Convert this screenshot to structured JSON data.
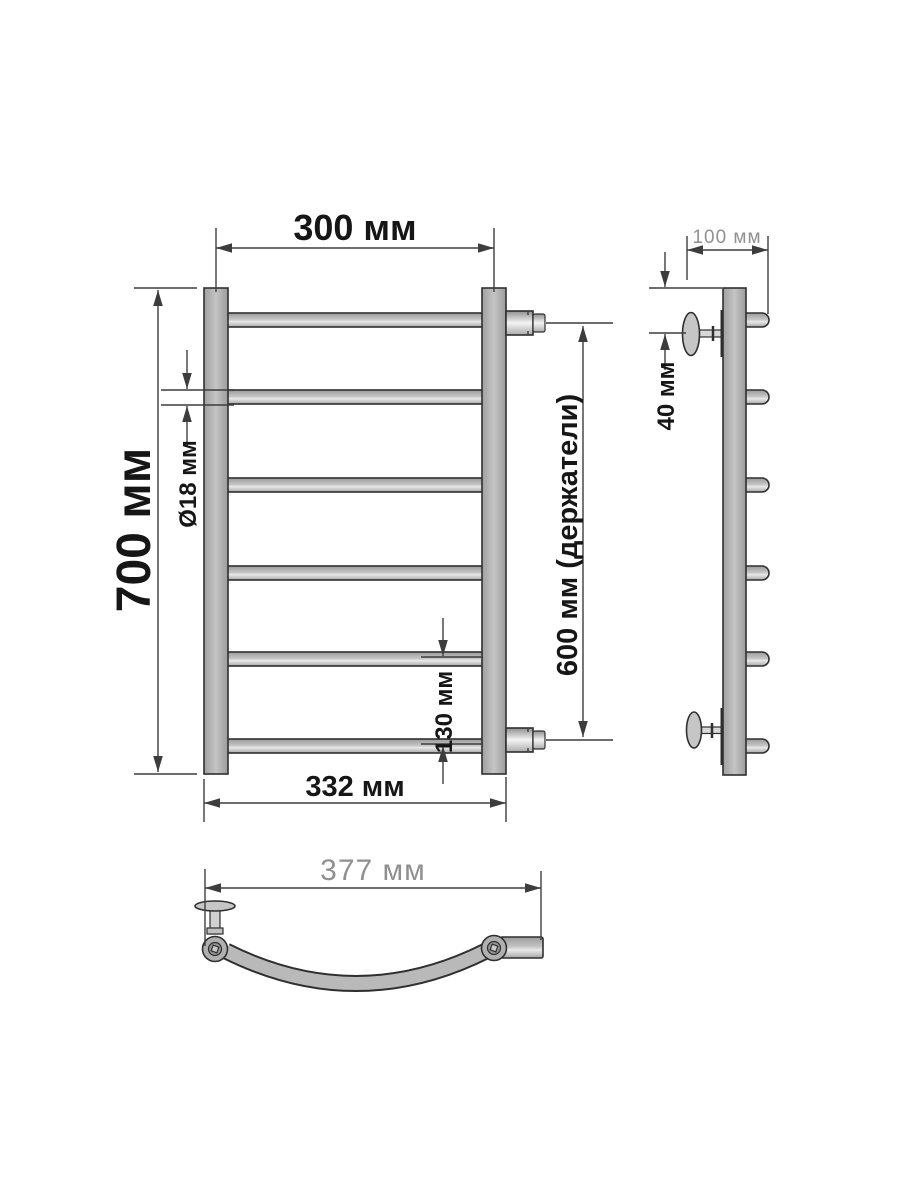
{
  "page": {
    "type": "technical-drawing",
    "subject": "ladder towel rail dimensional drawing, three views"
  },
  "colors": {
    "background": "#ffffff",
    "metal": "#b4b4b4",
    "outline": "#2f2f2f",
    "dim": "#3d3d3d",
    "text_dark": "#161616",
    "text_gray": "#909090"
  },
  "front_view": {
    "rung_count": 6,
    "dims": {
      "top_width": "300 мм",
      "height": "700 мм",
      "tube_diameter": "Ø18 мм",
      "holders_span": "600 мм (держатели)",
      "lower_rung_gap": "130 мм",
      "bottom_width": "332 мм"
    }
  },
  "side_view": {
    "dims": {
      "depth": "100 мм",
      "bracket_offset": "40 мм"
    }
  },
  "top_view": {
    "dims": {
      "arc_width": "377 мм"
    }
  }
}
